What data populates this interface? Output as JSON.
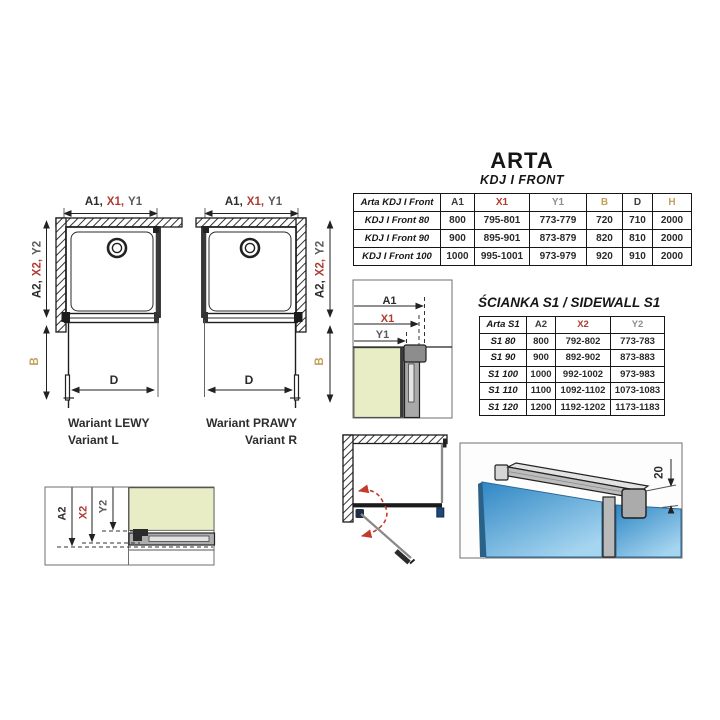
{
  "page": {
    "title": "ARTA",
    "subtitle": "KDJ I FRONT"
  },
  "sidewall_title": "ŚCIANKA S1 / SIDEWALL S1",
  "front_table": {
    "headers": [
      {
        "label": "Arta KDJ I Front",
        "color": "#161616"
      },
      {
        "label": "A1",
        "color": "#3c3c3c"
      },
      {
        "label": "X1",
        "color": "#b03a30"
      },
      {
        "label": "Y1",
        "color": "#8f8f8f"
      },
      {
        "label": "B",
        "color": "#c2a05e"
      },
      {
        "label": "D",
        "color": "#3c3c3c"
      },
      {
        "label": "H",
        "color": "#c2a05e"
      }
    ],
    "rows": [
      {
        "label": "KDJ I Front 80",
        "values": [
          "800",
          "795-801",
          "773-779",
          "720",
          "710",
          "2000"
        ]
      },
      {
        "label": "KDJ I Front 90",
        "values": [
          "900",
          "895-901",
          "873-879",
          "820",
          "810",
          "2000"
        ]
      },
      {
        "label": "KDJ I Front 100",
        "values": [
          "1000",
          "995-1001",
          "973-979",
          "920",
          "910",
          "2000"
        ]
      }
    ]
  },
  "sidewall_table": {
    "headers": [
      {
        "label": "Arta S1",
        "color": "#161616"
      },
      {
        "label": "A2",
        "color": "#3c3c3c"
      },
      {
        "label": "X2",
        "color": "#b03a30"
      },
      {
        "label": "Y2",
        "color": "#8f8f8f"
      }
    ],
    "rows": [
      {
        "label": "S1 80",
        "values": [
          "800",
          "792-802",
          "773-783"
        ]
      },
      {
        "label": "S1 90",
        "values": [
          "900",
          "892-902",
          "873-883"
        ]
      },
      {
        "label": "S1 100",
        "values": [
          "1000",
          "992-1002",
          "973-983"
        ]
      },
      {
        "label": "S1 110",
        "values": [
          "1100",
          "1092-1102",
          "1073-1083"
        ]
      },
      {
        "label": "S1 120",
        "values": [
          "1200",
          "1192-1202",
          "1173-1183"
        ]
      }
    ]
  },
  "labels": {
    "a1c": "A1,",
    "x1c": "X1,",
    "y1c": "Y1",
    "a2c": "A2,",
    "x2c": "X2,",
    "y2c": "Y2",
    "a1": "A1",
    "x1": "X1",
    "y1": "Y1",
    "a2": "A2",
    "x2": "X2",
    "y2": "Y2",
    "b": "B",
    "d": "D",
    "bar_offset": "20"
  },
  "captions": {
    "left_line1": "Wariant LEWY",
    "left_line2": "Variant L",
    "right_line1": "Wariant PRAWY",
    "right_line2": "Variant R"
  },
  "colors": {
    "red": "#b03a30",
    "ygray": "#8f8f8f",
    "olive": "#c2a05e",
    "green": "#e9edc6",
    "blue1": "#2f87c4",
    "blue2": "#a6d5f0",
    "navy": "#1d4878",
    "redarrow": "#c23b2e",
    "ink": "#1f1f1f"
  }
}
